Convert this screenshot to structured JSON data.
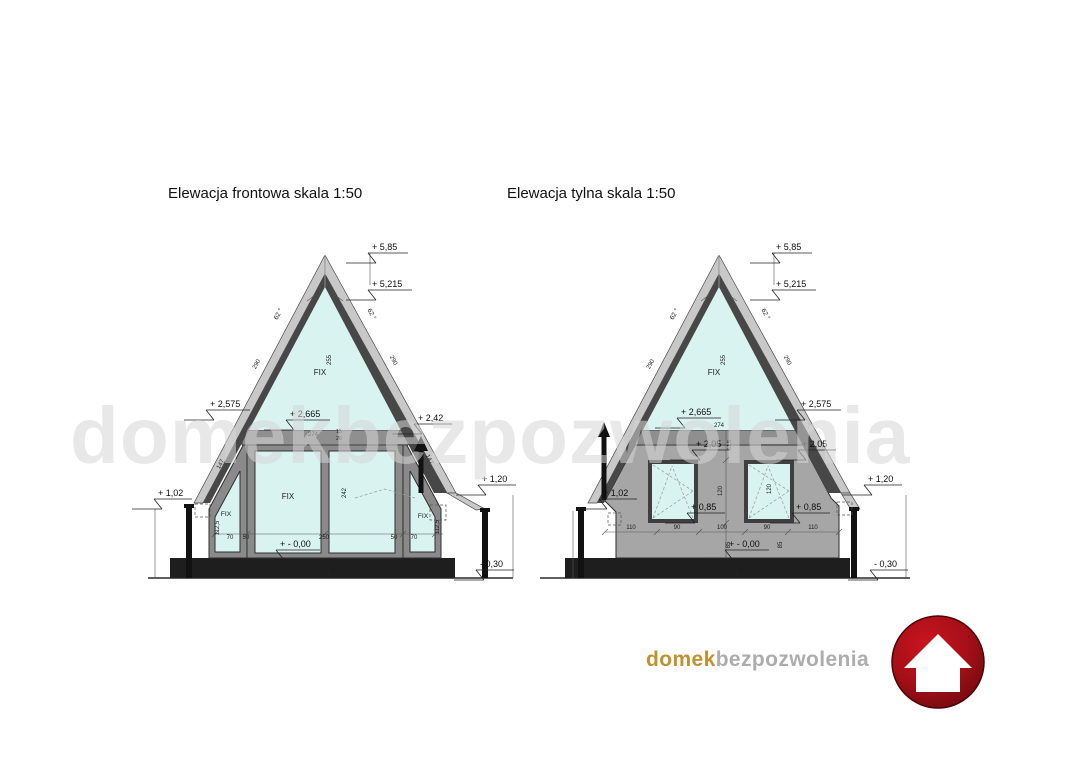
{
  "watermark": "domekbezpozwolenia",
  "titles": {
    "front": "Elewacja frontowa skala 1:50",
    "rear": "Elewacja tylna skala 1:50"
  },
  "front": {
    "levels": {
      "peak": "+ 5,85",
      "ridge": "+ 5,215",
      "roof_left": "+ 2,575",
      "glass_base": "+ 2,665",
      "vent": "+ 2,42",
      "eave_left": "+ 1,02",
      "eave_right": "+ 1,20",
      "floor": "+ - 0,00",
      "ground": "- 0,30"
    },
    "angle": "62 °",
    "dims": {
      "slope_upper": "290",
      "slope_lower": "147",
      "glass_height": "255",
      "beam_width": "274",
      "beam_d1": "15",
      "beam_d2": "26",
      "door_glass_height": "242",
      "side_window_height": "112,5",
      "side_window_width": "70",
      "mullion": "50",
      "door_width": "250",
      "plinth_height": "30"
    },
    "labels": {
      "fix": "FIX"
    }
  },
  "rear": {
    "levels": {
      "peak": "+ 5,85",
      "ridge": "+ 5,215",
      "glass_base": "+ 2,665",
      "roof_right": "+ 2,575",
      "window_head_left": "+ 2,05",
      "window_head_right": "+ 2,05",
      "eave_left": "+ 1,02",
      "sill_left": "+ 0,85",
      "sill_right": "+ 0,85",
      "eave_right": "+ 1,20",
      "floor": "+ - 0,00",
      "ground": "- 0,30"
    },
    "angle": "62 °",
    "dims": {
      "slope_upper": "290",
      "glass_height": "255",
      "beam_width": "274",
      "beam_offset": "61,5",
      "window_height": "120",
      "sill_height": "85",
      "bottom": [
        "110",
        "90",
        "100",
        "90",
        "110"
      ],
      "plinth_height": "30"
    },
    "labels": {
      "fix": "FIX"
    }
  },
  "logo": {
    "brand_primary": "domek",
    "brand_secondary": "bezpozwolenia",
    "icon": "house-icon"
  },
  "colors": {
    "glass": "#d9f3f1",
    "roof": "#c8c8c8",
    "roof_lining": "#474747",
    "wall": "#a6a6a6",
    "frame": "#8a8a8a",
    "plinth": "#1e1e1e",
    "watermark": "#d6d6d6",
    "logo_gold": "#c1922f",
    "logo_gray": "#adadad",
    "logo_red_light": "#c9141f",
    "logo_red_dark": "#70090f"
  }
}
